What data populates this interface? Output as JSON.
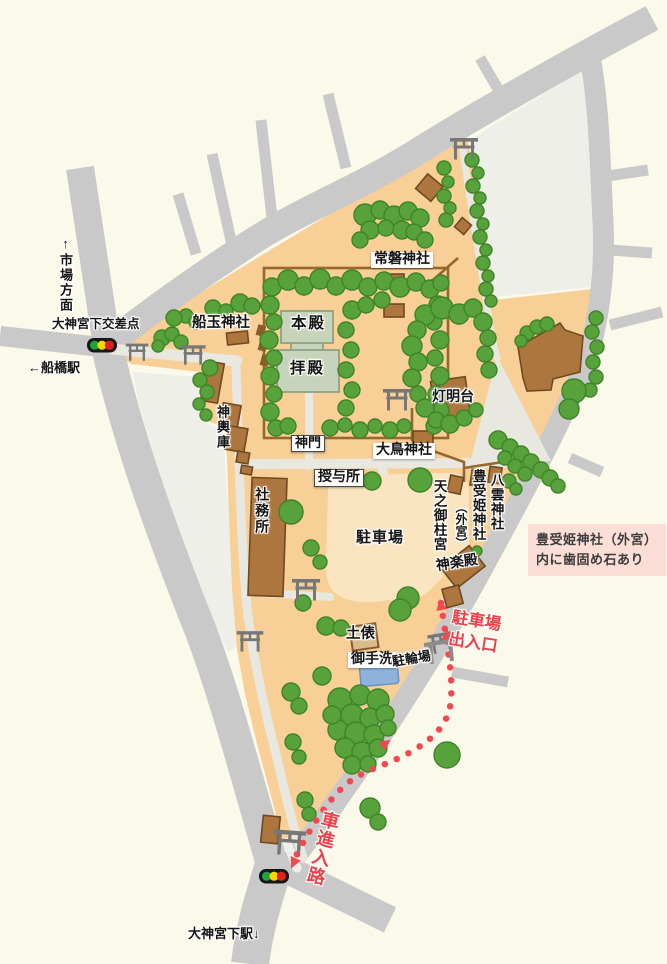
{
  "map_title_context": "shrine precinct guide map",
  "palette": {
    "background": "#FBF9E9",
    "city_block": "#EFEFEA",
    "road": "#C9C9C9",
    "grounds": "#F8CF96",
    "parking": "#FBE5C0",
    "path": "#E8E8E1",
    "tree_fill": "#57A23A",
    "tree_stroke": "#3F8428",
    "building_fill": "#AC763E",
    "building_stroke": "#6F4A20",
    "hall_fill": "#C8D3BB",
    "hall_stroke": "#8FA182",
    "fence": "#96682F",
    "route_red": "#EF3F47",
    "note_bg": "#FBDFD6",
    "torii": "#777777",
    "water": "#8FB2DC",
    "signal_green": "#1FA33C",
    "signal_yellow": "#F5D800",
    "signal_red": "#E31E1E"
  },
  "labels": {
    "ichiba_homen": "↑市場方面",
    "kosaten": "大神宮下交差点",
    "funabashi_eki": "←船橋駅",
    "funadama": "船玉神社",
    "tokiwa": "常磐神社",
    "honden": "本殿",
    "haiden": "拝殿",
    "shinmon": "神門",
    "mikoshiko": "神輿庫",
    "tomyodai": "灯明台",
    "otori": "大鳥神社",
    "juyosho": "授与所",
    "shamusho": "社務所",
    "chushajo": "駐車場",
    "amenomihashira": "天之御柱宮",
    "toyouke": "豊受姫神社",
    "gekuu": "（外宮）",
    "yakumo": "八雲神社",
    "kaguraden": "神楽殿",
    "note_line1": "豊受姫神社（外宮）",
    "note_line2": "内に歯固め石あり",
    "parking_exit_line1": "駐車場",
    "parking_exit_line2": "出入口",
    "dohyo": "土俵",
    "mitarashi": "御手洗",
    "churinjo": "駐輪場",
    "car_route": "車進入路",
    "station_bottom": "大神宮下駅↓"
  }
}
